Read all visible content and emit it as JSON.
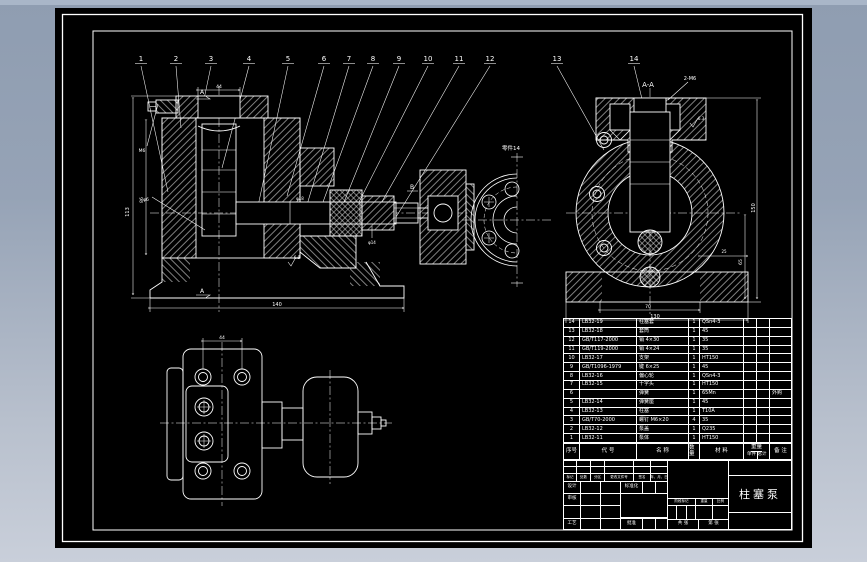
{
  "app": {
    "canvas_bg": "#000000",
    "line_color": "#ffffff",
    "background_top": "#8f9db1",
    "background_bottom": "#c9cfda",
    "top_strip": "#a9b6c8"
  },
  "views": {
    "main": {
      "callouts": [
        "1",
        "2",
        "3",
        "4",
        "5",
        "6",
        "7",
        "8",
        "9",
        "10",
        "11",
        "12"
      ],
      "section_top": "A",
      "section_bottom": "A",
      "section_b": "B",
      "dims": {
        "total_h": "113",
        "inner_h": "86",
        "cap_w": "44",
        "total_w": "140",
        "screw": "M6",
        "hole": "φ6",
        "shaft": "φ18",
        "gland": "φ14",
        "finish": "6.3"
      }
    },
    "side": {
      "callouts": [
        "13",
        "14"
      ],
      "title": "A-A",
      "thread": "2-M6",
      "dims": {
        "h": "150",
        "h2": "65",
        "w": "130",
        "w2": "70",
        "base": "25",
        "finish": "6.3"
      }
    },
    "flange": {
      "label": "零件14"
    },
    "plan": {
      "dim_top": "44"
    }
  },
  "bom": {
    "headers": {
      "no": "序号",
      "code": "代 号",
      "name": "名 称",
      "qty": "数量",
      "material": "材 料",
      "weight": "重量",
      "weight_each": "单件",
      "weight_total": "总计",
      "remark": "备 注"
    },
    "rows": [
      {
        "no": "14",
        "code": "LB32-19",
        "name": "柱塞套",
        "qty": "1",
        "material": "QSn4-3",
        "remark": ""
      },
      {
        "no": "13",
        "code": "LB32-18",
        "name": "套筒",
        "qty": "1",
        "material": "45",
        "remark": ""
      },
      {
        "no": "12",
        "code": "GB/T117-2000",
        "name": "销 4×30",
        "qty": "1",
        "material": "35",
        "remark": ""
      },
      {
        "no": "11",
        "code": "GB/T119-2000",
        "name": "销 4×24",
        "qty": "1",
        "material": "35",
        "remark": ""
      },
      {
        "no": "10",
        "code": "LB32-17",
        "name": "支架",
        "qty": "1",
        "material": "HT150",
        "remark": ""
      },
      {
        "no": "9",
        "code": "GB/T1096-1979",
        "name": "键 6×25",
        "qty": "1",
        "material": "45",
        "remark": ""
      },
      {
        "no": "8",
        "code": "LB32-16",
        "name": "偏心轮",
        "qty": "1",
        "material": "QSn4-3",
        "remark": ""
      },
      {
        "no": "7",
        "code": "LB32-15",
        "name": "十字头",
        "qty": "1",
        "material": "HT150",
        "remark": ""
      },
      {
        "no": "6",
        "code": "",
        "name": "弹簧",
        "qty": "1",
        "material": "65Mn",
        "remark": "外购"
      },
      {
        "no": "5",
        "code": "LB32-14",
        "name": "弹簧座",
        "qty": "1",
        "material": "45",
        "remark": ""
      },
      {
        "no": "4",
        "code": "LB32-13",
        "name": "柱塞",
        "qty": "1",
        "material": "T10A",
        "remark": ""
      },
      {
        "no": "3",
        "code": "GB/T70-2000",
        "name": "螺钉 M6×20",
        "qty": "4",
        "material": "35",
        "remark": ""
      },
      {
        "no": "2",
        "code": "LB32-12",
        "name": "泵盖",
        "qty": "1",
        "material": "Q235",
        "remark": ""
      },
      {
        "no": "1",
        "code": "LB32-11",
        "name": "泵体",
        "qty": "1",
        "material": "HT150",
        "remark": ""
      }
    ]
  },
  "title_block": {
    "part_name": "柱塞泵",
    "cols": {
      "mark": "标记",
      "count": "处数",
      "zone": "分区",
      "doc": "更改文件号",
      "sign": "签名",
      "date": "年、月、日"
    },
    "roles": {
      "design": "设计",
      "check": "审核",
      "process": "工艺",
      "standard": "标准化",
      "approve": "批准"
    },
    "stage": {
      "stage": "阶段标记",
      "weight": "重量",
      "scale": "比例"
    },
    "sheets": {
      "total": "共 张",
      "page": "第 张"
    }
  }
}
